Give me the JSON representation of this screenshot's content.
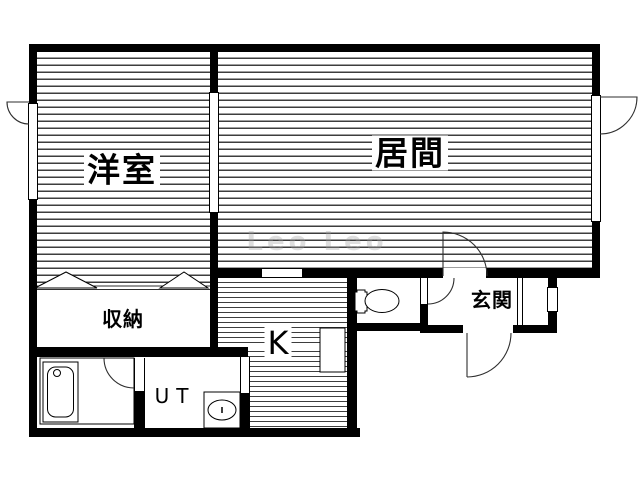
{
  "rooms": {
    "western_room": "洋室",
    "living_room": "居間",
    "storage": "収納",
    "kitchen": "K",
    "utility": "UT",
    "entrance": "玄関"
  },
  "watermark": "Leo Leo",
  "fixtures": {
    "bathtub": "bathtub",
    "toilet": "toilet",
    "utility_sink": "utility-sink",
    "kitchen_counter": "kitchen-counter",
    "closet_rod": "closet-rod-symbol"
  },
  "colors": {
    "wall": "#000000",
    "line": "#2e2e2e",
    "hatch": "#3d3d3d",
    "background": "#ffffff"
  }
}
